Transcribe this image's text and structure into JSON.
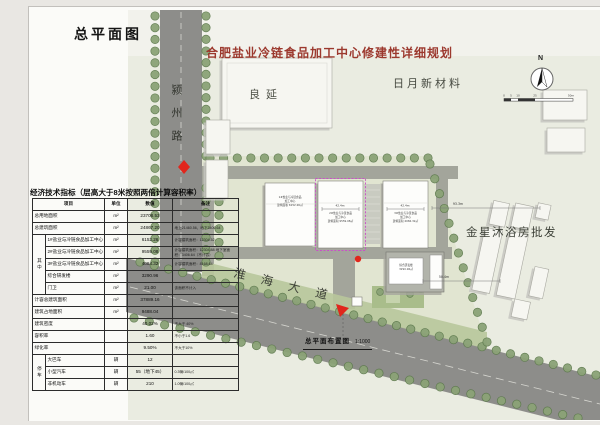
{
  "page": {
    "doc_title": "总平面图",
    "main_title": "合肥盐业冷链食品加工中心修建性详细规划",
    "caption": "总平面布置图",
    "caption_scale": "1:1000",
    "north_label": "N",
    "scale_ticks": [
      "0",
      "5",
      "10",
      "25",
      "50m"
    ]
  },
  "labels": {
    "road_west": "颍州路",
    "road_south": "淮海大道",
    "neighbor_top": "良延",
    "neighbor_topright": "日月新材料",
    "neighbor_right": "金星沐浴房批发"
  },
  "dims": {
    "d1": "93.3m",
    "d2": "50.4m",
    "d3": "42.4m",
    "d4": "42.4m"
  },
  "plan": {
    "colors": {
      "plan_bg": "#eaece1",
      "plan_top": "#f2f2ec",
      "parcel": "#e1e5d1",
      "road": "#8d8d8a",
      "road_line": "#d6d6d0",
      "inner_road": "#a3a59b",
      "grass": "#b8c69b",
      "park": "#a9bd8b",
      "tree_fill": "#8ba377",
      "tree_stroke": "#5e7a4e",
      "bld_fill": "#fdfdfb",
      "bld_stroke": "#80807a",
      "bld_shadow": "#a6a69e",
      "ctx_fill": "#f6f6f1",
      "ctx_stroke": "#a8a8a0",
      "ctx_shadow": "#c6c6bf",
      "roof": "#b2b4ab",
      "magenta": "#cb4ec9",
      "red": "#e1261c"
    },
    "building_notes": {
      "b1": [
        "1#盐业与冷链食品",
        "加工中心",
        "建筑面积 6152.26㎡"
      ],
      "b2": [
        "2#盐业与冷链食品",
        "加工中心",
        "建筑面积 9559.08㎡"
      ],
      "b3": [
        "3#盐业与冷链食品",
        "加工中心",
        "建筑面积 4084.32㎡"
      ],
      "b4": [
        "综合研发楼",
        "3290.96㎡"
      ]
    }
  },
  "table": {
    "title": "经济技术指标（层高大于8米按照两倍计算容积率）",
    "headers": [
      "项目",
      "单位",
      "数值",
      "备注"
    ],
    "rows": [
      {
        "item": "总用地面积",
        "unit": "m²",
        "value": "23708.53",
        "note": ""
      },
      {
        "item": "总建筑面积",
        "unit": "m²",
        "value": "24867.20",
        "note": "地上21460.56，地下3406.64"
      },
      {
        "group": "其中",
        "span": 5,
        "item": "1#盐业与冷链食品加工中心",
        "unit": "m²",
        "value": "6152.26",
        "note": "计容建筑面积：12304.52"
      },
      {
        "item": "2#盐业与冷链食品加工中心",
        "unit": "m²",
        "value": "9559.08",
        "note": "计容建筑面积：12304.88 地下室面积：3406.64（不计容）"
      },
      {
        "item": "3#盐业与冷链食品加工中心",
        "unit": "m²",
        "value": "4084.32",
        "note": "计容建筑面积：8168.64"
      },
      {
        "item": "综合研发楼",
        "unit": "m²",
        "value": "3290.96",
        "note": ""
      },
      {
        "item": "门卫",
        "unit": "m²",
        "value": "21.00",
        "note": "该面积不计入"
      },
      {
        "item": "计容总建筑面积",
        "unit": "m²",
        "value": "37889.16",
        "note": ""
      },
      {
        "item": "建筑占地面积",
        "unit": "m²",
        "value": "9488.04",
        "note": ""
      },
      {
        "item": "建筑密度",
        "unit": "",
        "value": "40.02%",
        "note": "不大于 40%"
      },
      {
        "item": "容积率",
        "unit": "",
        "value": "1.60",
        "note": "不小于1.6"
      },
      {
        "item": "绿化率",
        "unit": "",
        "value": "9.50%",
        "note": "不大于10%"
      },
      {
        "group": "停车",
        "span": 3,
        "item": "大巴车",
        "unit": "辆",
        "value": "12",
        "note": ""
      },
      {
        "item": "小型汽车",
        "unit": "辆",
        "value": "55（地下45）",
        "note": "0.3辆/100㎡"
      },
      {
        "item": "非机动车",
        "unit": "辆",
        "value": "210",
        "note": "1.0辆/100㎡"
      }
    ]
  }
}
